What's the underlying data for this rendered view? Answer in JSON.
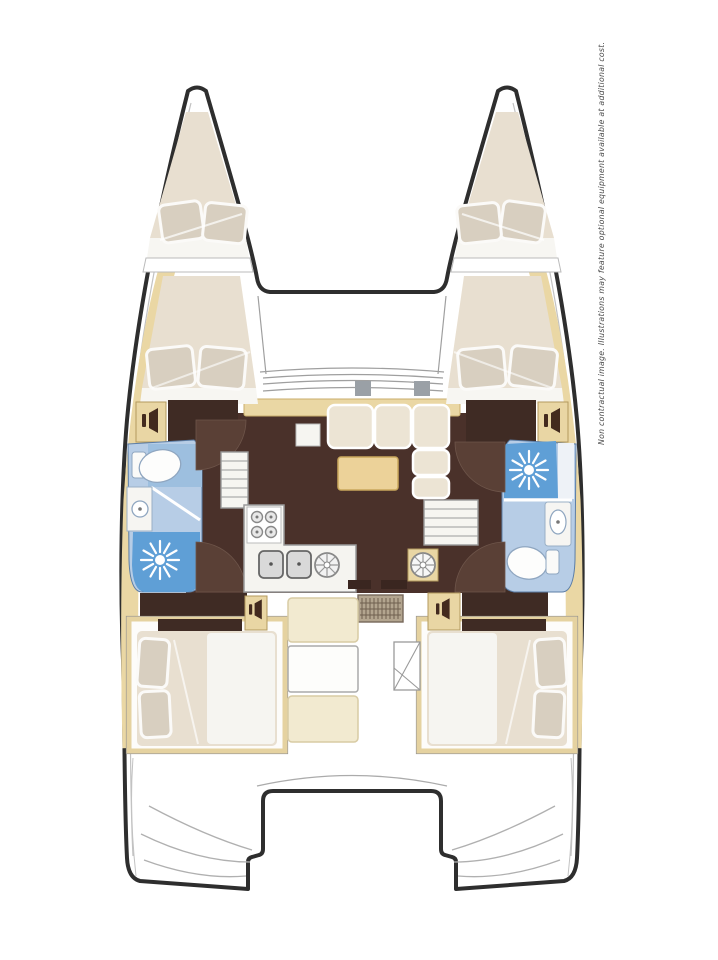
{
  "disclaimer": {
    "text": "Non contractual image. Illustrations may feature optional equipment available at additional cost."
  },
  "palette": {
    "hull_outline": "#2e2e2e",
    "thin_line": "#a8a8a8",
    "deck_sand": "#ead7a4",
    "cabinet_sand": "#e9d6a4",
    "table_sand": "#ecd299",
    "bench_cream": "#f2ead0",
    "floor_brown": "#4a312a",
    "door_arc_brown": "#5a4036",
    "wardrobe_brown": "#3f2b24",
    "mattress_cream": "#e8dfd0",
    "pillow_beige": "#d8cfc0",
    "sheet_white": "#f7f6f2",
    "bath_blue_light": "#b7cde6",
    "bath_blue_mid": "#9dbfdf",
    "shower_blue": "#5f9fd6",
    "fixture_white": "#fafaf8",
    "counter_white": "#f5f4f0",
    "mat_taupe": "#b3a58f"
  },
  "icons": [
    "shower-sunburst-icon",
    "toilet-icon",
    "sink-icon",
    "stove-burners-icon",
    "double-sink-icon",
    "round-hatch-icon",
    "locker-speaker-icon",
    "stairs-icon",
    "door-swing-icon",
    "cockpit-ladder-icon",
    "deck-mat-icon"
  ],
  "layout_summary": {
    "bow_berths": 2,
    "cabins": 4,
    "bathrooms": 2,
    "saloon": 1,
    "galley": 1,
    "cockpit": 1
  }
}
